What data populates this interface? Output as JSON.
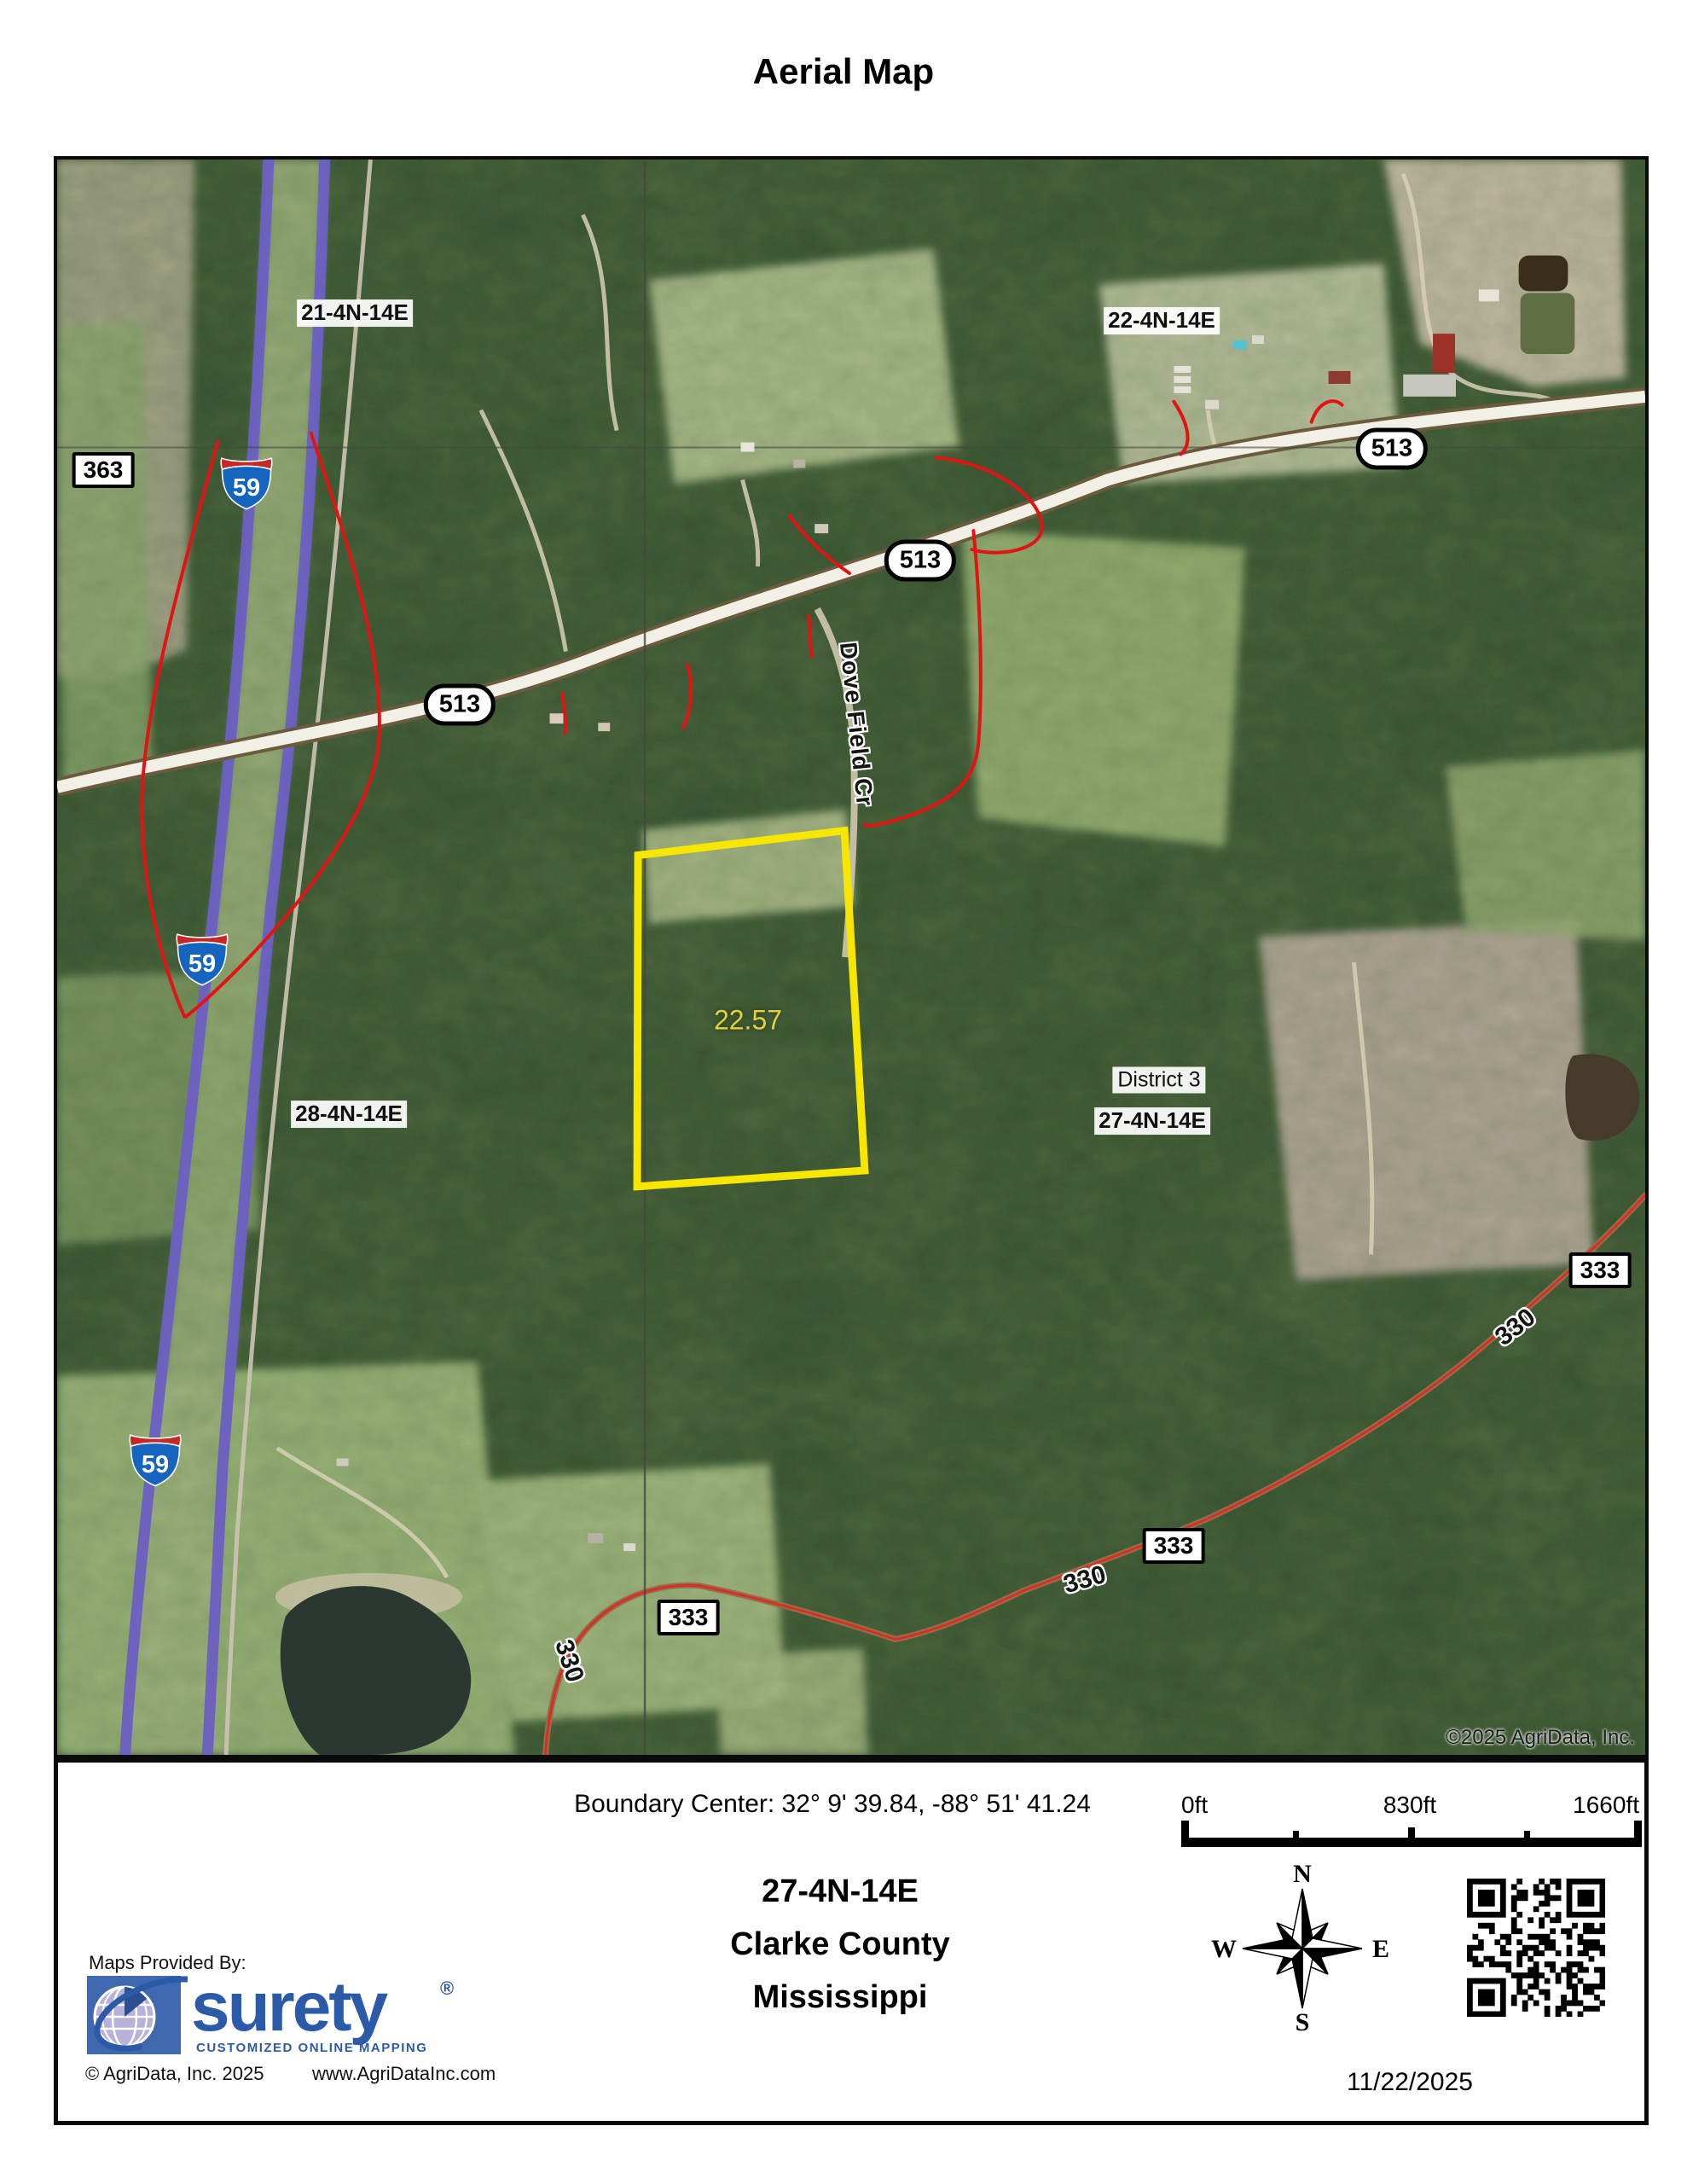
{
  "page_title": "Aerial Map",
  "map": {
    "copyright": "©2025 AgriData, Inc.",
    "acreage": "22.57",
    "road_name": "Dove Field Cr",
    "district": "District 3",
    "sections": {
      "nw": "21-4N-14E",
      "ne": "22-4N-14E",
      "sw": "28-4N-14E",
      "se": "27-4N-14E"
    },
    "interstate_number": "59",
    "highway_number": "513",
    "road_333": "333",
    "road_330": "330",
    "road_363": "363",
    "boundary_color": "#f7e600",
    "overlay_red": "#e11414",
    "interstate_color": "#6c60c4"
  },
  "footer": {
    "boundary_center": "Boundary Center: 32° 9' 39.84,  -88° 51' 41.24",
    "scale": {
      "start": "0ft",
      "mid": "830ft",
      "end": "1660ft"
    },
    "location": {
      "section": "27-4N-14E",
      "county": "Clarke County",
      "state": "Mississippi"
    },
    "compass": {
      "n": "N",
      "e": "E",
      "s": "S",
      "w": "W"
    },
    "date": "11/22/2025",
    "provider": {
      "heading": "Maps Provided By:",
      "brand": "surety",
      "registered": "®",
      "tagline": "CUSTOMIZED ONLINE MAPPING",
      "copyright": "© AgriData, Inc. 2025",
      "website": "www.AgriDataInc.com"
    }
  }
}
